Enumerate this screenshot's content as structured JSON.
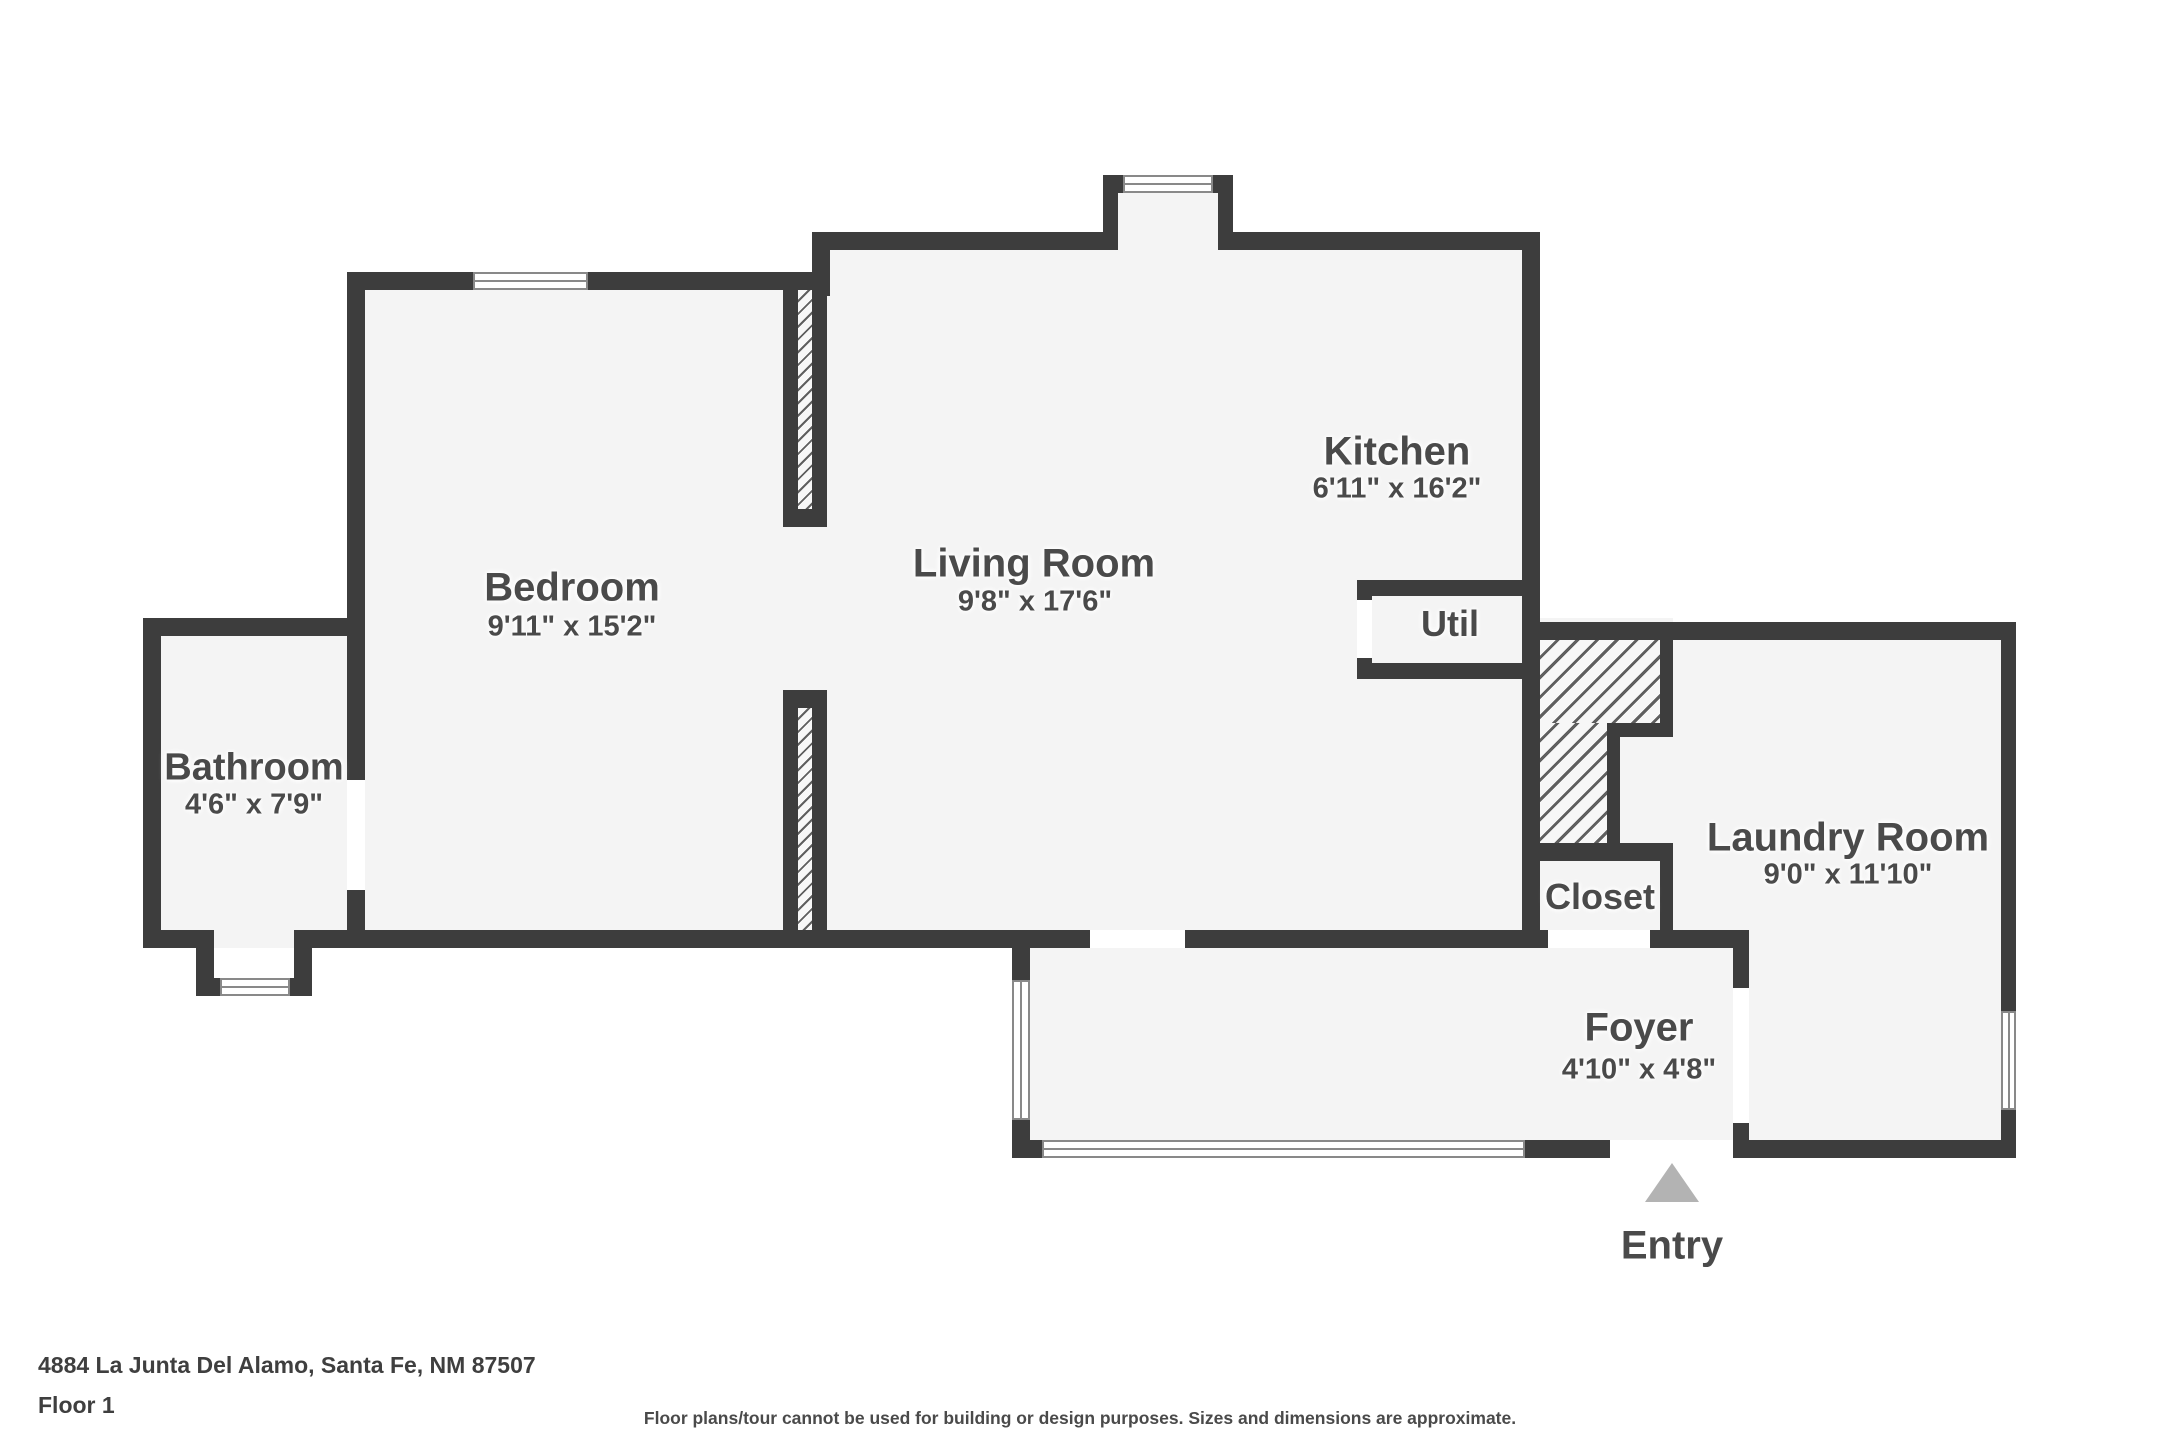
{
  "colors": {
    "wall": "#3d3d3d",
    "room_fill": "#f4f4f4",
    "label_text": "#4a4a4a",
    "entry_arrow": "#b3b3b3",
    "window_frame": "#898989"
  },
  "rooms": {
    "bedroom": {
      "name": "Bedroom",
      "dims": "9'11\" x 15'2\""
    },
    "living": {
      "name": "Living Room",
      "dims": "9'8\" x 17'6\""
    },
    "kitchen": {
      "name": "Kitchen",
      "dims": "6'11\" x 16'2\""
    },
    "util": {
      "name": "Util"
    },
    "bathroom": {
      "name": "Bathroom",
      "dims": "4'6\" x 7'9\""
    },
    "closet": {
      "name": "Closet"
    },
    "laundry": {
      "name": "Laundry Room",
      "dims": "9'0\" x 11'10\""
    },
    "foyer": {
      "name": "Foyer",
      "dims": "4'10\" x 4'8\""
    }
  },
  "entry": {
    "label": "Entry"
  },
  "footer": {
    "address": "4884 La Junta Del Alamo, Santa Fe, NM 87507",
    "floor": "Floor 1",
    "disclaimer": "Floor plans/tour cannot be used for building or design purposes. Sizes and dimensions are approximate."
  }
}
